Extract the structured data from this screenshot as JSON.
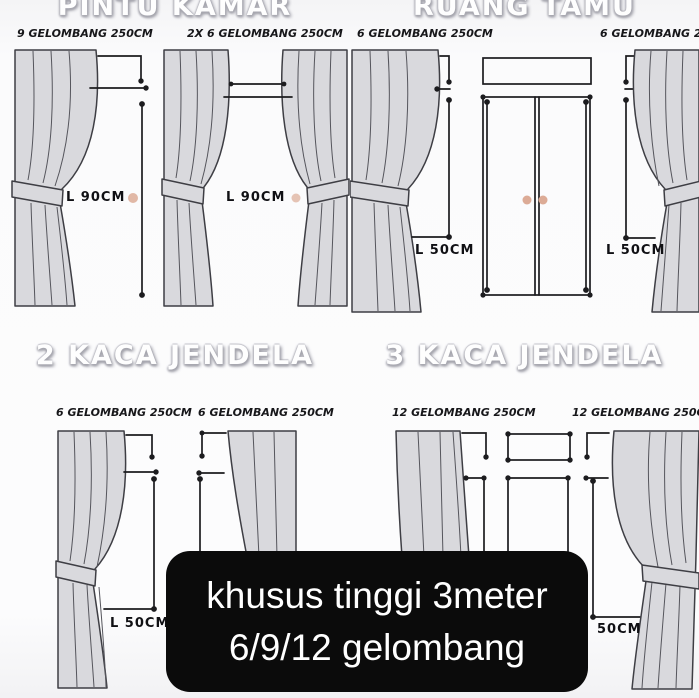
{
  "colors": {
    "curtain_fill": "#d9d9dd",
    "line_color": "#1c1c1f",
    "knob_dot": "#dcab96",
    "banner_bg": "#0b0b0b",
    "banner_text": "#ffffff"
  },
  "sections": {
    "pintu_kamar": {
      "title": "PINTU KAMAR",
      "diagrams": [
        {
          "label": "9 GELOMBANG 250CM",
          "measure": "L 90CM"
        },
        {
          "label": "2X 6 GELOMBANG 250CM",
          "measure": "L 90CM"
        }
      ]
    },
    "ruang_tamu": {
      "title": "RUANG TAMU",
      "diagrams": [
        {
          "label": "6 GELOMBANG 250CM",
          "measure": "L 50CM"
        },
        {
          "label": "6 GELOMBANG 250CM",
          "measure": "L 50CM"
        }
      ]
    },
    "kaca2": {
      "title": "2 KACA JENDELA",
      "diagrams": [
        {
          "label": "6 GELOMBANG 250CM",
          "measure": "L 50CM"
        },
        {
          "label": "6 GELOMBANG 250CM"
        }
      ]
    },
    "kaca3": {
      "title": "3 KACA JENDELA",
      "diagrams": [
        {
          "label": "12 GELOMBANG 250CM"
        },
        {
          "label": "12 GELOMBANG 250CM",
          "measure": "50CM"
        }
      ]
    }
  },
  "banner": {
    "line1": "khusus tinggi 3meter",
    "line2": "6/9/12 gelombang"
  }
}
